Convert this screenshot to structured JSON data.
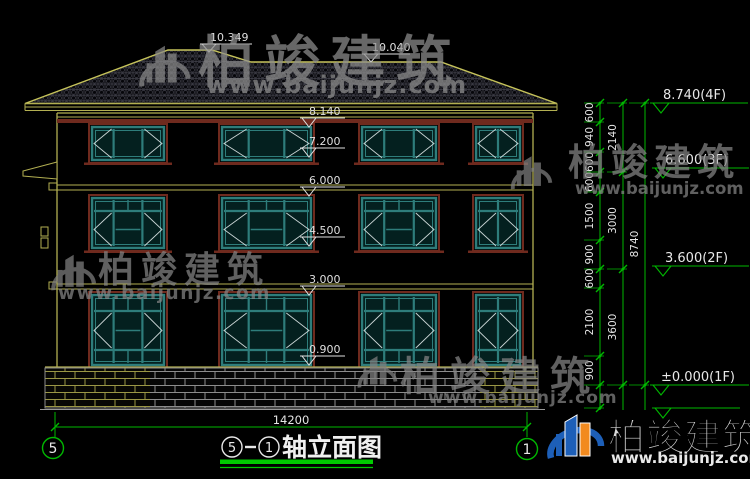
{
  "drawing": {
    "title": {
      "axis_from": "5",
      "axis_to": "1",
      "dash": "—",
      "name": "轴立面图"
    },
    "bottom_axis": {
      "left": "5",
      "right": "1"
    },
    "total_width_dim": "14200",
    "levels": {
      "ridge_left": "10.349",
      "ridge_right": "10.040",
      "parapet": "8.140",
      "f3_window_head": "7.200",
      "f3_band": "6.000",
      "f2_window_head": "4.500",
      "f2_band": "3.000",
      "f1_sill": "0.900",
      "right_4f": "8.740(4F)",
      "right_3f": "6.600(3F)",
      "right_2f": "3.600(2F)",
      "right_1f": "±0.000(1F)"
    },
    "dimensions": {
      "col1": [
        "600",
        "940",
        "600",
        "600",
        "1500",
        "900",
        "600",
        "2100",
        "900"
      ],
      "col2": [
        "2140",
        "3000",
        "3600"
      ],
      "col3": [
        "8740"
      ]
    }
  },
  "watermark": {
    "brand": "柏竣建筑",
    "url": "www.baijunjz.com"
  },
  "colors": {
    "accent_green": "#00b800",
    "line_yellow": "#b3b052",
    "roof_outline": "#c6c35a",
    "window_teal": "#2e7d7b",
    "trim_maroon": "#6f2a1e",
    "logo_blue": "#1d5fb8",
    "logo_orange": "#f28a1e"
  }
}
